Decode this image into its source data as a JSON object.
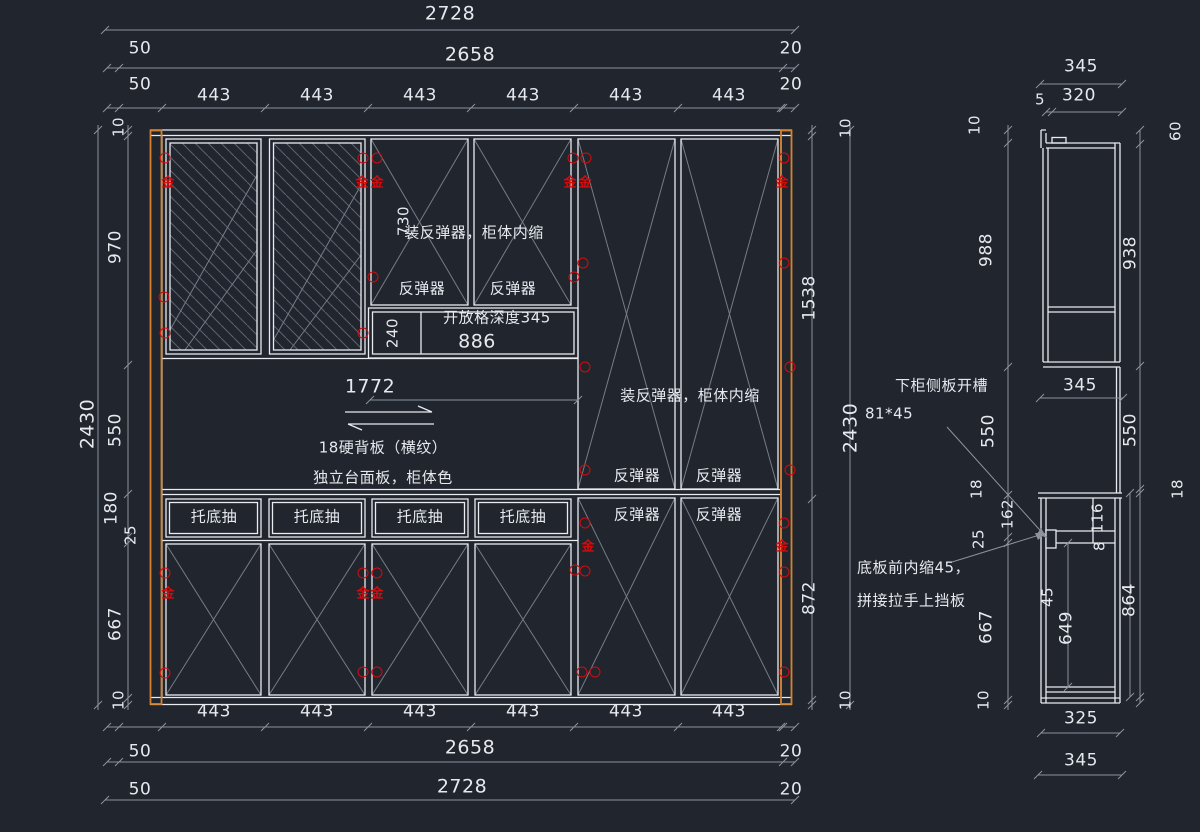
{
  "drawing_title": "cabinet-elevation-and-section-cad",
  "colors": {
    "bg": "#20252e",
    "line": "#e8ebf0",
    "dim": "#8d939c",
    "diag": "#767d87",
    "orange": "#d6812c",
    "red": "#d60b0b",
    "text": "#e6e9ee"
  },
  "hinge_glyph": "金",
  "annotations": {
    "rebounder_inset": "装反弹器，柜体内缩",
    "rebounder": "反弹器",
    "open_shelf": "开放格深度345",
    "drawer": "托底抽",
    "backboard": "18硬背板（横纹）",
    "countertop": "独立台面板，柜体色",
    "side_slot_1": "下柜侧板开槽",
    "side_slot_2": "81*45",
    "bottom_note_1": "底板前内缩45，",
    "bottom_note_2": "拼接拉手上挡板"
  },
  "labels": [
    {
      "t": "2728",
      "x": 450,
      "y": 14,
      "s": 19
    },
    {
      "t": "50",
      "x": 140,
      "y": 49,
      "s": 17
    },
    {
      "t": "2658",
      "x": 470,
      "y": 55,
      "s": 19
    },
    {
      "t": "20",
      "x": 791,
      "y": 49,
      "s": 17
    },
    {
      "t": "50",
      "x": 140,
      "y": 85,
      "s": 17
    },
    {
      "t": "443",
      "x": 214,
      "y": 96,
      "s": 17
    },
    {
      "t": "443",
      "x": 317,
      "y": 96,
      "s": 17
    },
    {
      "t": "443",
      "x": 420,
      "y": 96,
      "s": 17
    },
    {
      "t": "443",
      "x": 523,
      "y": 96,
      "s": 17
    },
    {
      "t": "443",
      "x": 626,
      "y": 96,
      "s": 17
    },
    {
      "t": "443",
      "x": 729,
      "y": 96,
      "s": 17
    },
    {
      "t": "20",
      "x": 791,
      "y": 85,
      "s": 17
    },
    {
      "t": "443",
      "x": 214,
      "y": 712,
      "s": 17
    },
    {
      "t": "443",
      "x": 317,
      "y": 712,
      "s": 17
    },
    {
      "t": "443",
      "x": 420,
      "y": 712,
      "s": 17
    },
    {
      "t": "443",
      "x": 523,
      "y": 712,
      "s": 17
    },
    {
      "t": "443",
      "x": 626,
      "y": 712,
      "s": 17
    },
    {
      "t": "443",
      "x": 729,
      "y": 712,
      "s": 17
    },
    {
      "t": "50",
      "x": 140,
      "y": 752,
      "s": 17
    },
    {
      "t": "2658",
      "x": 470,
      "y": 748,
      "s": 19
    },
    {
      "t": "20",
      "x": 791,
      "y": 752,
      "s": 17
    },
    {
      "t": "50",
      "x": 140,
      "y": 790,
      "s": 17
    },
    {
      "t": "2728",
      "x": 462,
      "y": 787,
      "s": 19
    },
    {
      "t": "20",
      "x": 791,
      "y": 790,
      "s": 17
    },
    {
      "t": "10",
      "x": 119,
      "y": 127,
      "r": -90
    },
    {
      "t": "970",
      "x": 116,
      "y": 247,
      "r": -90,
      "s": 17
    },
    {
      "t": "2430",
      "x": 88,
      "y": 424,
      "r": -90,
      "s": 19
    },
    {
      "t": "550",
      "x": 116,
      "y": 430,
      "r": -90,
      "s": 17
    },
    {
      "t": "180",
      "x": 112,
      "y": 508,
      "r": -90,
      "s": 17
    },
    {
      "t": "25",
      "x": 131,
      "y": 535,
      "r": -90
    },
    {
      "t": "667",
      "x": 116,
      "y": 624,
      "r": -90,
      "s": 17
    },
    {
      "t": "10",
      "x": 119,
      "y": 700,
      "r": -90
    },
    {
      "t": "10",
      "x": 846,
      "y": 128,
      "r": -90
    },
    {
      "t": "1538",
      "x": 810,
      "y": 298,
      "r": -90,
      "s": 17
    },
    {
      "t": "2430",
      "x": 851,
      "y": 428,
      "r": -90,
      "s": 19
    },
    {
      "t": "872",
      "x": 810,
      "y": 598,
      "r": -90,
      "s": 17
    },
    {
      "t": "10",
      "x": 846,
      "y": 700,
      "r": -90
    },
    {
      "t": "730",
      "x": 404,
      "y": 221,
      "r": -90
    },
    {
      "t": "装反弹器，柜体内缩",
      "x": 474,
      "y": 233
    },
    {
      "t": "反弹器",
      "x": 422,
      "y": 289
    },
    {
      "t": "反弹器",
      "x": 513,
      "y": 289
    },
    {
      "t": "240",
      "x": 393,
      "y": 333,
      "r": -90
    },
    {
      "t": "开放格深度345",
      "x": 497,
      "y": 318
    },
    {
      "t": "886",
      "x": 477,
      "y": 342,
      "s": 19
    },
    {
      "t": "1772",
      "x": 370,
      "y": 387,
      "s": 19
    },
    {
      "t": "18硬背板（横纹）",
      "x": 383,
      "y": 448
    },
    {
      "t": "独立台面板，柜体色",
      "x": 383,
      "y": 478
    },
    {
      "t": "托底抽",
      "x": 214,
      "y": 517
    },
    {
      "t": "托底抽",
      "x": 317,
      "y": 517
    },
    {
      "t": "托底抽",
      "x": 420,
      "y": 517
    },
    {
      "t": "托底抽",
      "x": 523,
      "y": 517
    },
    {
      "t": "装反弹器，柜体内缩",
      "x": 690,
      "y": 396
    },
    {
      "t": "反弹器",
      "x": 637,
      "y": 476
    },
    {
      "t": "反弹器",
      "x": 719,
      "y": 476
    },
    {
      "t": "反弹器",
      "x": 637,
      "y": 515
    },
    {
      "t": "反弹器",
      "x": 719,
      "y": 515
    },
    {
      "t": "345",
      "x": 1081,
      "y": 67,
      "s": 17
    },
    {
      "t": "5",
      "x": 1040,
      "y": 100
    },
    {
      "t": "320",
      "x": 1079,
      "y": 96,
      "s": 17
    },
    {
      "t": "10",
      "x": 975,
      "y": 125,
      "r": -90
    },
    {
      "t": "60",
      "x": 1176,
      "y": 131,
      "r": -90
    },
    {
      "t": "988",
      "x": 987,
      "y": 250,
      "r": -90,
      "s": 17
    },
    {
      "t": "938",
      "x": 1131,
      "y": 253,
      "r": -90,
      "s": 17
    },
    {
      "t": "345",
      "x": 1080,
      "y": 386,
      "s": 17
    },
    {
      "t": "550",
      "x": 989,
      "y": 431,
      "r": -90,
      "s": 17
    },
    {
      "t": "550",
      "x": 1131,
      "y": 430,
      "r": -90,
      "s": 17
    },
    {
      "t": "18",
      "x": 977,
      "y": 489,
      "r": -90
    },
    {
      "t": "162",
      "x": 1008,
      "y": 514,
      "r": -90
    },
    {
      "t": "25",
      "x": 979,
      "y": 539,
      "r": -90
    },
    {
      "t": "116",
      "x": 1098,
      "y": 518,
      "r": -90
    },
    {
      "t": "8",
      "x": 1100,
      "y": 546,
      "r": -90
    },
    {
      "t": "18",
      "x": 1178,
      "y": 489,
      "r": -90
    },
    {
      "t": "45",
      "x": 1048,
      "y": 597,
      "r": -90
    },
    {
      "t": "649",
      "x": 1067,
      "y": 628,
      "r": -90,
      "s": 17
    },
    {
      "t": "864",
      "x": 1130,
      "y": 600,
      "r": -90,
      "s": 17
    },
    {
      "t": "667",
      "x": 987,
      "y": 627,
      "r": -90,
      "s": 17
    },
    {
      "t": "10",
      "x": 984,
      "y": 700,
      "r": -90
    },
    {
      "t": "325",
      "x": 1081,
      "y": 719,
      "s": 17
    },
    {
      "t": "345",
      "x": 1081,
      "y": 761,
      "s": 17
    },
    {
      "t": "下柜侧板开槽",
      "x": 895,
      "y": 386,
      "a": "l"
    },
    {
      "t": "81*45",
      "x": 865,
      "y": 414,
      "a": "l"
    },
    {
      "t": "底板前内缩45，",
      "x": 857,
      "y": 568,
      "a": "l"
    },
    {
      "t": "拼接拉手上挡板",
      "x": 857,
      "y": 601,
      "a": "l"
    }
  ],
  "hinges": [
    {
      "x": 165,
      "y": 158,
      "k": "c"
    },
    {
      "x": 363,
      "y": 158,
      "k": "c"
    },
    {
      "x": 377,
      "y": 158,
      "k": "c"
    },
    {
      "x": 573,
      "y": 158,
      "k": "c"
    },
    {
      "x": 586,
      "y": 158,
      "k": "c"
    },
    {
      "x": 784,
      "y": 158,
      "k": "c"
    },
    {
      "x": 168,
      "y": 183,
      "k": "j"
    },
    {
      "x": 362,
      "y": 183,
      "k": "j"
    },
    {
      "x": 377,
      "y": 183,
      "k": "j"
    },
    {
      "x": 570,
      "y": 183,
      "k": "j"
    },
    {
      "x": 585,
      "y": 183,
      "k": "j"
    },
    {
      "x": 782,
      "y": 183,
      "k": "j"
    },
    {
      "x": 164,
      "y": 297,
      "k": "c"
    },
    {
      "x": 373,
      "y": 277,
      "k": "c"
    },
    {
      "x": 583,
      "y": 263,
      "k": "c"
    },
    {
      "x": 574,
      "y": 277,
      "k": "c"
    },
    {
      "x": 784,
      "y": 263,
      "k": "c"
    },
    {
      "x": 165,
      "y": 333,
      "k": "c"
    },
    {
      "x": 363,
      "y": 333,
      "k": "c"
    },
    {
      "x": 585,
      "y": 367,
      "k": "c"
    },
    {
      "x": 790,
      "y": 367,
      "k": "c"
    },
    {
      "x": 585,
      "y": 470,
      "k": "c"
    },
    {
      "x": 790,
      "y": 470,
      "k": "c"
    },
    {
      "x": 585,
      "y": 523,
      "k": "c"
    },
    {
      "x": 784,
      "y": 523,
      "k": "c"
    },
    {
      "x": 588,
      "y": 547,
      "k": "j"
    },
    {
      "x": 782,
      "y": 547,
      "k": "j"
    },
    {
      "x": 575,
      "y": 570,
      "k": "c"
    },
    {
      "x": 585,
      "y": 571,
      "k": "c"
    },
    {
      "x": 784,
      "y": 572,
      "k": "c"
    },
    {
      "x": 165,
      "y": 573,
      "k": "c"
    },
    {
      "x": 363,
      "y": 573,
      "k": "c"
    },
    {
      "x": 377,
      "y": 573,
      "k": "c"
    },
    {
      "x": 168,
      "y": 594,
      "k": "j"
    },
    {
      "x": 363,
      "y": 594,
      "k": "j"
    },
    {
      "x": 377,
      "y": 594,
      "k": "j"
    },
    {
      "x": 165,
      "y": 673,
      "k": "c"
    },
    {
      "x": 363,
      "y": 672,
      "k": "c"
    },
    {
      "x": 377,
      "y": 672,
      "k": "c"
    },
    {
      "x": 582,
      "y": 672,
      "k": "c"
    },
    {
      "x": 595,
      "y": 672,
      "k": "c"
    },
    {
      "x": 784,
      "y": 672,
      "k": "c"
    }
  ]
}
